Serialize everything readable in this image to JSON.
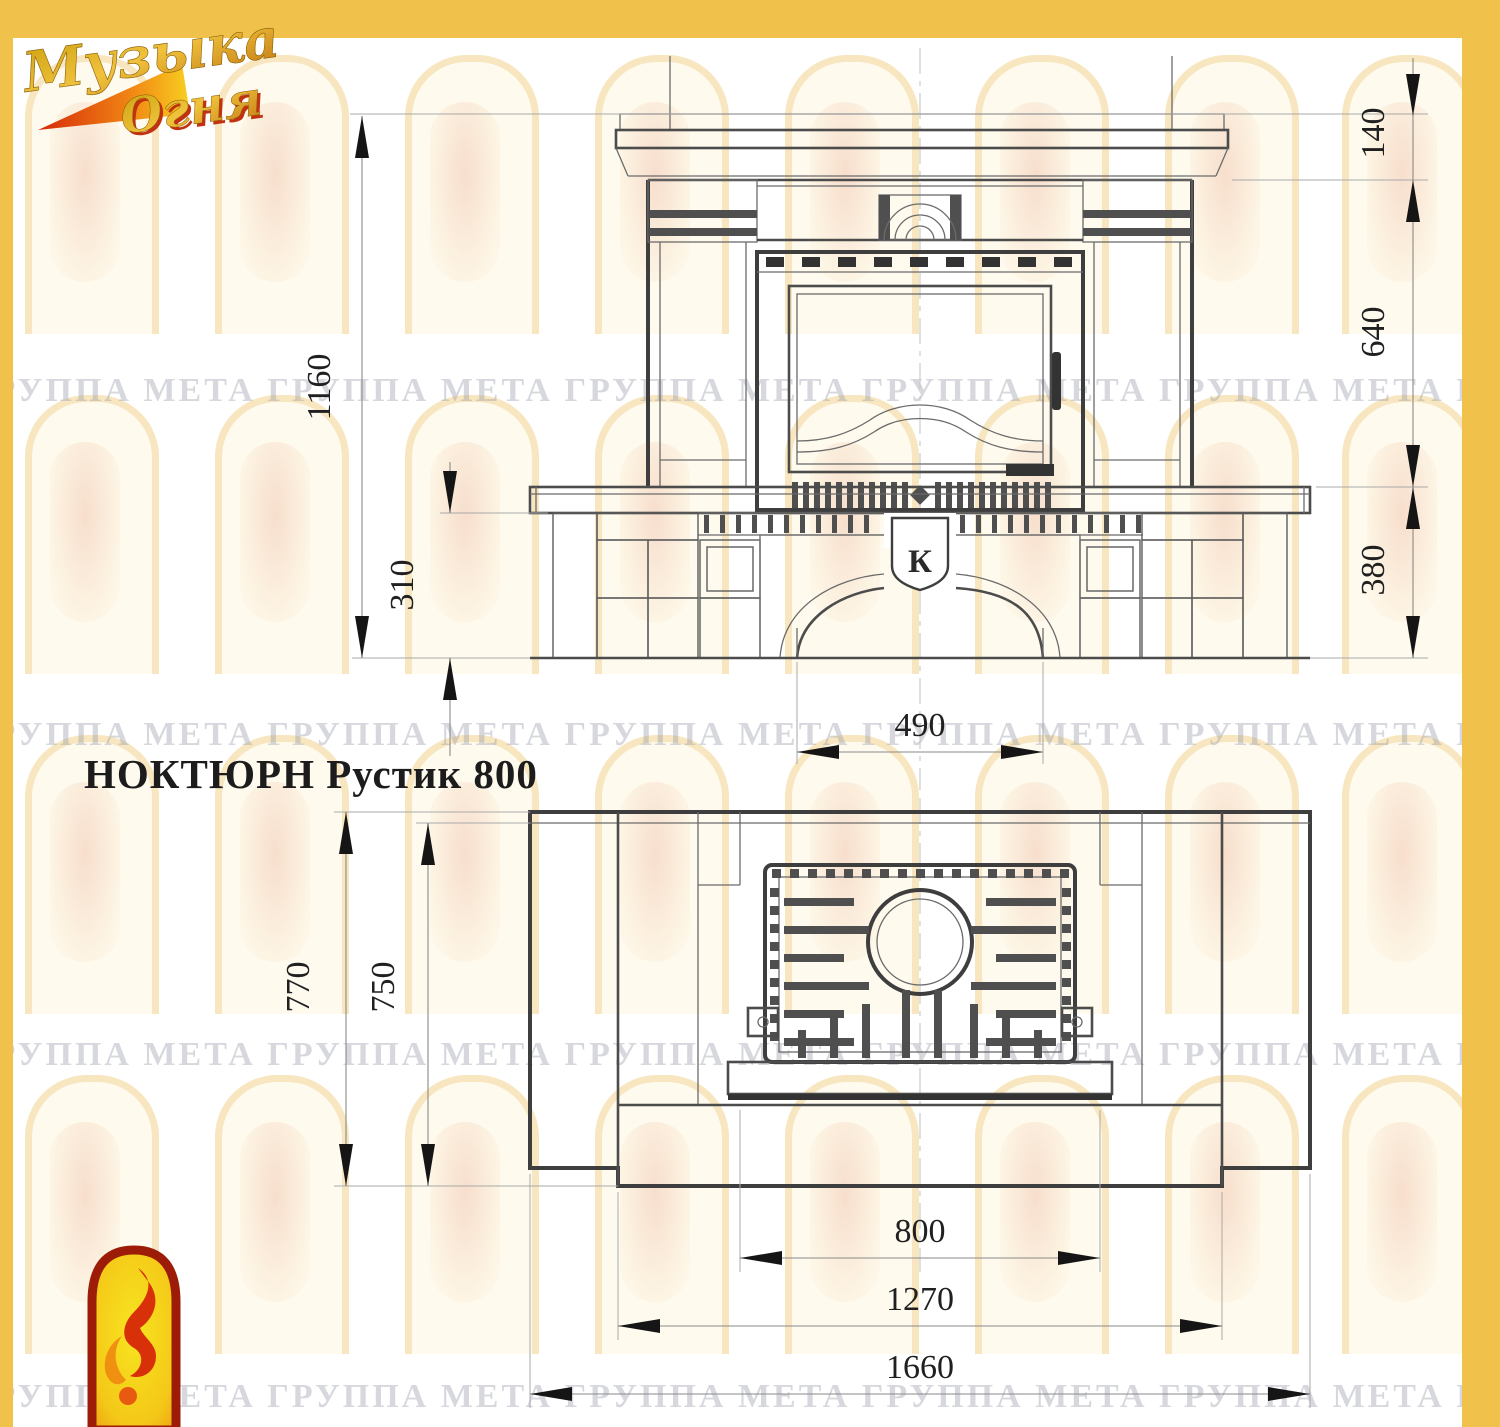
{
  "page": {
    "frame_color": "#f0c24c"
  },
  "brand": {
    "logo_line1": "Музыка",
    "logo_line2": "Огня"
  },
  "title": "НОКТЮРН Рустик 800",
  "watermark": {
    "text": "ГРУППА МЕТА"
  },
  "emblem": {
    "letter": "К"
  },
  "dims": {
    "front_total_height": "1160",
    "front_plinth_height": "310",
    "front_cornice_height": "140",
    "front_body_height": "640",
    "front_base_height": "380",
    "front_portal_width": "490",
    "plan_depth_outer": "770",
    "plan_depth_inner": "750",
    "plan_insert_width": "800",
    "plan_hearth_width": "1270",
    "plan_total_width": "1660"
  }
}
